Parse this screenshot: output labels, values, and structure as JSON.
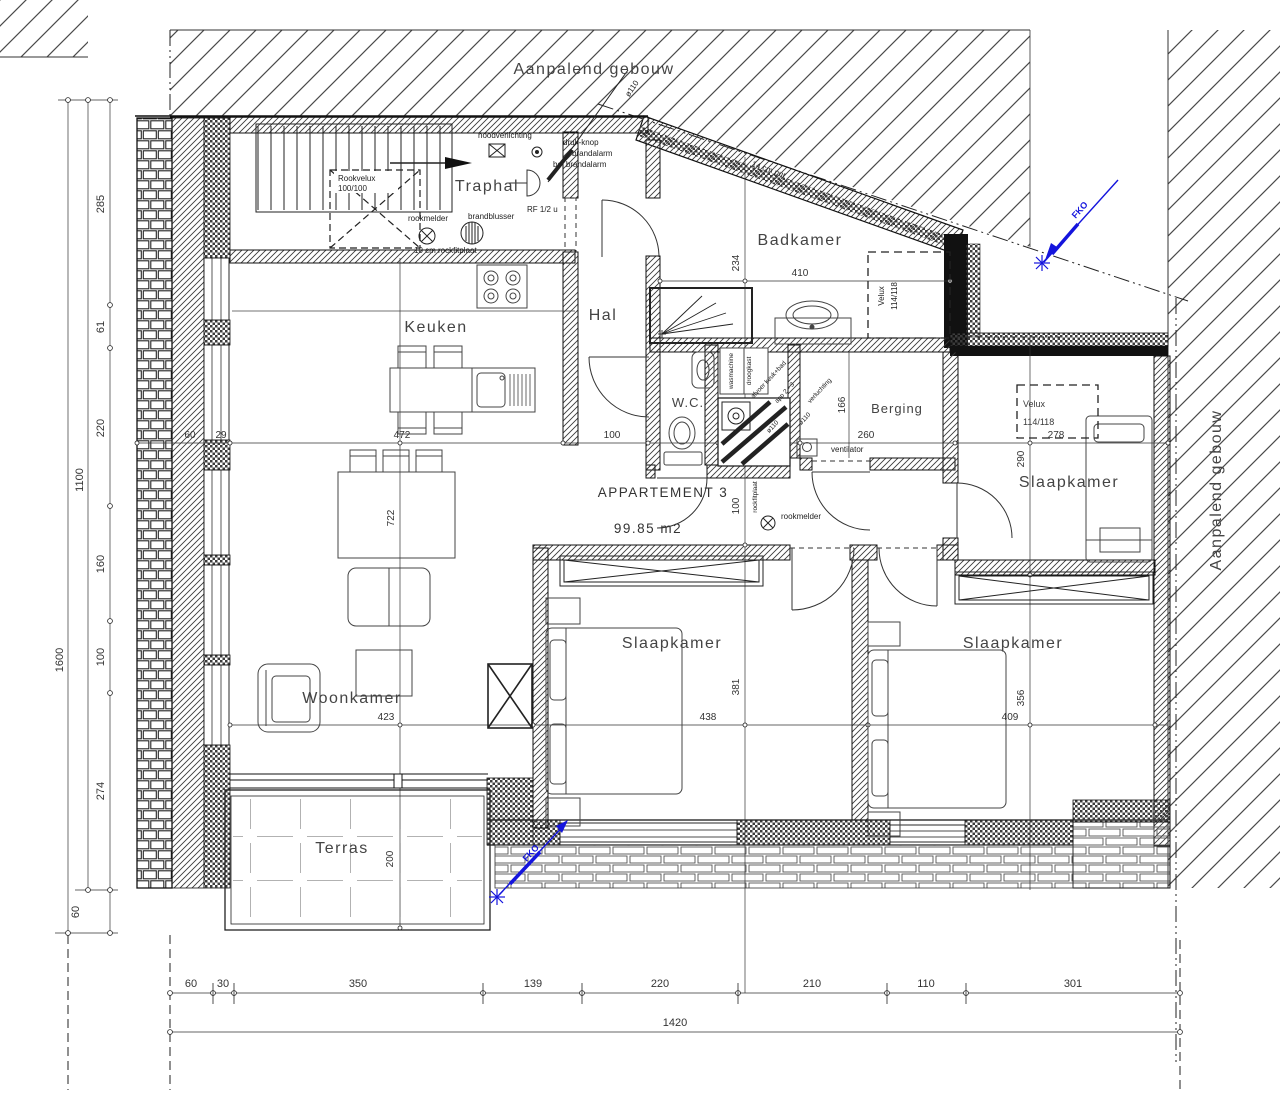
{
  "adjacent_top": "Aanpalend gebouw",
  "adjacent_right": "Aanpalend gebouw",
  "apartment": {
    "name": "APPARTEMENT 3",
    "area": "99.85 m2"
  },
  "rooms": {
    "traphal": "Traphal",
    "keuken": "Keuken",
    "hal": "Hal",
    "badkamer": "Badkamer",
    "wc": "W.C.",
    "berging": "Berging",
    "slaapkamer_top": "Slaapkamer",
    "slaapkamer_left": "Slaapkamer",
    "slaapkamer_right": "Slaapkamer",
    "woonkamer": "Woonkamer",
    "terras": "Terras"
  },
  "safety": {
    "noodverlichting": "noodverlichting",
    "drukknop": "druk-knop",
    "brandalarm": "brandalarm",
    "bel_brandalarm": "bel brandalarm",
    "rookmelder": "rookmelder",
    "brandblusser": "brandblusser",
    "rookmelder2": "rookmelder",
    "fire_door": "RF 1/2 u"
  },
  "skylights": {
    "rookvelux_l1": "Rookvelux",
    "rookvelux_l2": "100/100",
    "velux_bad_l1": "Velux",
    "velux_bad_l2": "114/118",
    "velux_slaap_l1": "Velux",
    "velux_slaap_l2": "114/118"
  },
  "notes": {
    "wall_note": "10 cm rockfitplaat",
    "roof_note": "14 cm pur",
    "vent_pipe": "ø110",
    "afvoer": "afvoer keuk+bad",
    "afvoer2": "app 2 - 3",
    "verluchting": "verluchting",
    "diam_a": "ø110",
    "diam_b": "ø110",
    "ventilator": "ventilator",
    "wasmachine": "wasmachine",
    "droogkast": "droogkast",
    "duct_note": "rockfitplaat"
  },
  "revision": {
    "top": "FKO",
    "bottom": "FKO"
  },
  "dims": {
    "left": {
      "d285": "285",
      "d61": "61",
      "d220": "220",
      "d160": "160",
      "d100": "100",
      "d274": "274",
      "d60": "60",
      "total_inner": "1100",
      "total_outer": "1600"
    },
    "bottom": {
      "d60": "60",
      "d30": "30",
      "d350": "350",
      "d139": "139",
      "d220": "220",
      "d210": "210",
      "d110": "110",
      "d301": "301",
      "total": "1420"
    },
    "inner": {
      "d60": "60",
      "d29": "29",
      "d472": "472",
      "d100_hal": "100",
      "d260": "260",
      "d278": "278",
      "d423": "423",
      "d438": "438",
      "d409": "409",
      "d410": "410",
      "d234": "234",
      "d166": "166",
      "d290": "290",
      "d722": "722",
      "d100_mid": "100",
      "d381": "381",
      "d356": "356",
      "d200": "200"
    }
  }
}
